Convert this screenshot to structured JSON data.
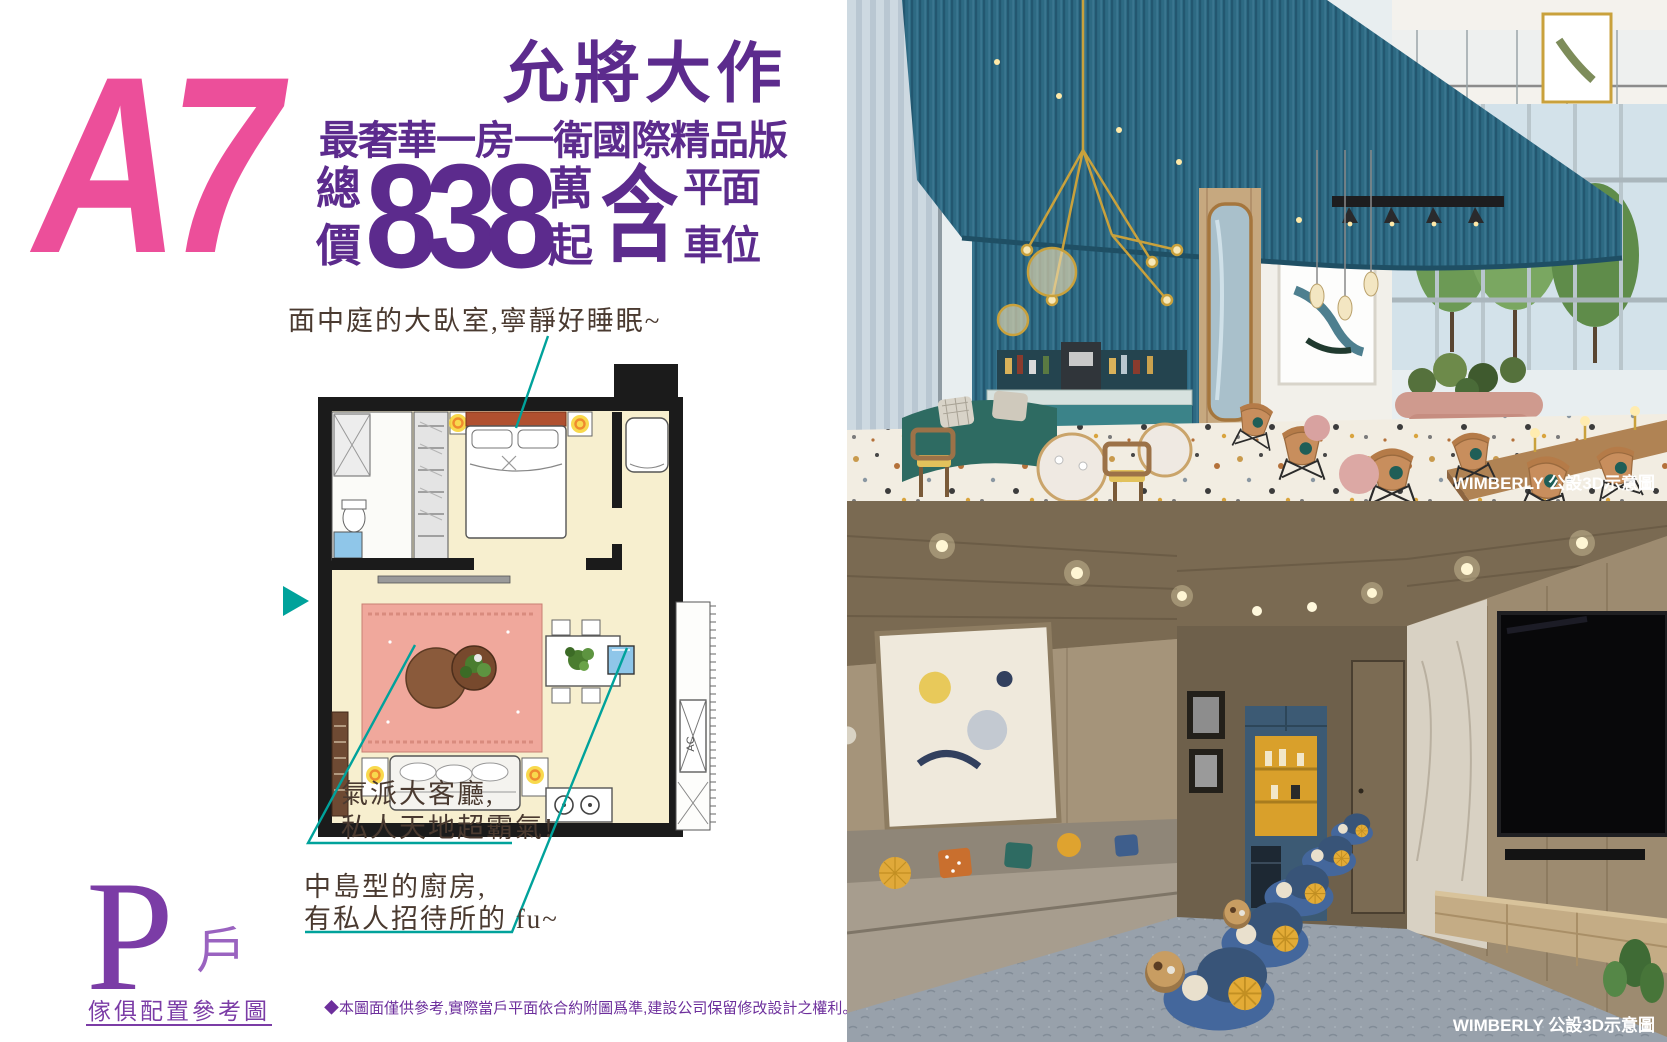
{
  "colors": {
    "purple": "#5c2b8d",
    "purple_light": "#9a63c0",
    "pink": "#ec4f9a",
    "teal": "#00a29b",
    "handwriting_ink": "#4a3a30",
    "disclaimer_purple": "#6d2f9c",
    "credit_white": "#ffffff"
  },
  "left_panel": {
    "unit_code": "A7",
    "headline": "允將大作",
    "subheadline": "最奢華一房一衛國際精品版",
    "price": {
      "prefix_top": "總",
      "prefix_bottom": "價",
      "amount": "838",
      "unit_top": "萬",
      "unit_bottom": "起",
      "include": "含",
      "include_line1": "平面",
      "include_line2": "車位"
    },
    "annotations": {
      "bedroom": {
        "text": "面中庭的大臥室,寧靜好睡眠~"
      },
      "living": {
        "line1": "氣派大客廳,",
        "line2": "私人天地超霸氣!"
      },
      "kitchen": {
        "line1": "中島型的廚房,",
        "line2": "有私人招待所的 fu~"
      }
    },
    "floor_plan": {
      "ac_label": "AC"
    },
    "unit_type": {
      "letter": "P",
      "suffix": "戶",
      "caption": "傢俱配置參考圖"
    },
    "disclaimer": "◆本圖面僅供參考,實際當戶平面依合約附圖爲準,建設公司保留修改設計之權利。"
  },
  "photos": [
    {
      "id": "lounge",
      "credit": "WIMBERLY 公設3D示意圖"
    },
    {
      "id": "media-room",
      "credit": "WIMBERLY 公設3D示意圖"
    }
  ]
}
